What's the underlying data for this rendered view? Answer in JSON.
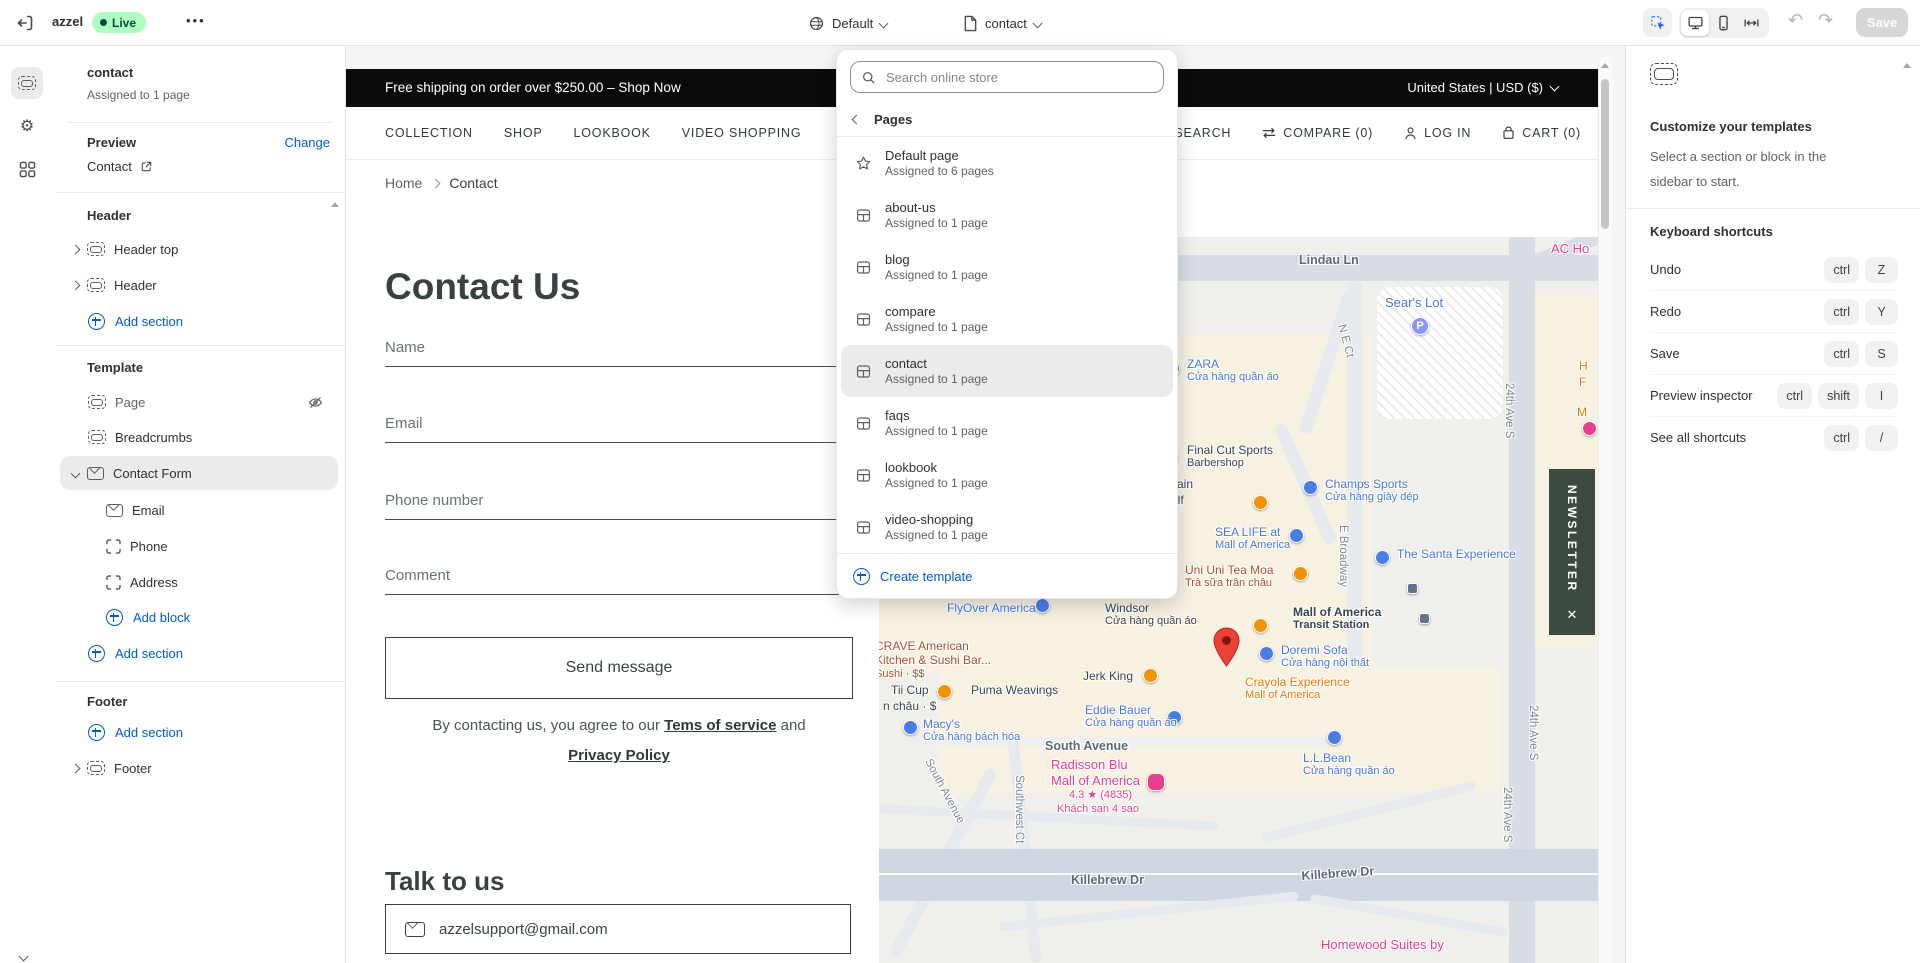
{
  "topbar": {
    "store_name": "azzel",
    "live_label": "Live",
    "more_label": "•••",
    "theme_name": "Default",
    "page_name": "contact",
    "save_label": "Save",
    "undo_glyph": "↶",
    "redo_glyph": "↷"
  },
  "sidebar": {
    "doc": {
      "title": "contact",
      "subtitle": "Assigned to 1 page"
    },
    "preview": {
      "label": "Preview",
      "change": "Change",
      "link": "Contact"
    },
    "header_group": {
      "title": "Header",
      "item1": "Header top",
      "item2": "Header",
      "add": "Add section"
    },
    "template_group": {
      "title": "Template",
      "page": "Page",
      "breadcrumbs": "Breadcrumbs",
      "contact_form": "Contact Form",
      "block1": "Email",
      "block2": "Phone",
      "block3": "Address",
      "add_block": "Add block",
      "add_section": "Add section"
    },
    "footer_group": {
      "title": "Footer",
      "add": "Add section",
      "footer": "Footer"
    }
  },
  "dropdown": {
    "search_placeholder": "Search online store",
    "back_label": "Pages",
    "items": [
      {
        "icon": "star",
        "title": "Default page",
        "subtitle": "Assigned to 6 pages"
      },
      {
        "icon": "template",
        "title": "about-us",
        "subtitle": "Assigned to 1 page"
      },
      {
        "icon": "template",
        "title": "blog",
        "subtitle": "Assigned to 1 page"
      },
      {
        "icon": "template",
        "title": "compare",
        "subtitle": "Assigned to 1 page"
      },
      {
        "icon": "template",
        "title": "contact",
        "subtitle": "Assigned to 1 page",
        "selected": true
      },
      {
        "icon": "template",
        "title": "faqs",
        "subtitle": "Assigned to 1 page"
      },
      {
        "icon": "template",
        "title": "lookbook",
        "subtitle": "Assigned to 1 page"
      },
      {
        "icon": "template",
        "title": "video-shopping",
        "subtitle": "Assigned to 1 page"
      }
    ],
    "create_label": "Create template"
  },
  "site": {
    "announcement": "Free shipping on order over $250.00 – Shop Now",
    "locale": "United States | USD ($)",
    "nav_links": [
      "COLLECTION",
      "SHOP",
      "LOOKBOOK",
      "VIDEO SHOPPING"
    ],
    "nav_utils": [
      "SEARCH",
      "COMPARE (0)",
      "LOG IN",
      "CART (0)"
    ],
    "breadcrumb_home": "Home",
    "breadcrumb_current": "Contact",
    "page_title": "Contact Us",
    "form": {
      "name_ph": "Name",
      "email_ph": "Email",
      "phone_ph": "Phone number",
      "comment_ph": "Comment",
      "submit": "Send message",
      "consent_prefix": "By contacting us, you agree to our ",
      "terms": "Tems of service",
      "consent_and": " and",
      "privacy": "Privacy Policy"
    },
    "talk_title": "Talk to us",
    "support_email": "azzelsupport@gmail.com",
    "newsletter": "NEWSLETTER",
    "newsletter_close": "✕"
  },
  "map": {
    "labels": [
      {
        "x": 420,
        "y": 16,
        "cls": "c-road b",
        "text": "Lindau Ln"
      },
      {
        "x": 672,
        "y": 4,
        "cls": "c-pink lg",
        "text": "AC Ho"
      },
      {
        "x": 506,
        "y": 58,
        "cls": "c-blue lg",
        "text": "Sear's Lot"
      },
      {
        "x": 532,
        "y": 80,
        "icon": "parking"
      },
      {
        "x": 468,
        "y": 86,
        "cls": "c-road",
        "rot": 75,
        "text": "N E Ct"
      },
      {
        "x": 286,
        "y": 124,
        "icon": "blue"
      },
      {
        "x": 308,
        "y": 120,
        "cls": "c-blue",
        "text": "ZARA",
        "sub": "Cửa hàng quần áo"
      },
      {
        "x": 700,
        "y": 122,
        "cls": "c-orange",
        "text": "H"
      },
      {
        "x": 700,
        "y": 138,
        "cls": "c-orange",
        "text": "F"
      },
      {
        "x": 698,
        "y": 168,
        "cls": "c-orange",
        "text": "M"
      },
      {
        "x": 703,
        "y": 184,
        "icon": "pink"
      },
      {
        "x": 636,
        "y": 146,
        "cls": "c-road",
        "rot": 90,
        "text": "24th Ave S"
      },
      {
        "x": 284,
        "y": 213,
        "icon": "black"
      },
      {
        "x": 308,
        "y": 206,
        "cls": "c-dark",
        "text": "Final Cut Sports",
        "sub": "Barbershop"
      },
      {
        "x": 288,
        "y": 240,
        "cls": "c-dark",
        "text": "ntain"
      },
      {
        "x": 292,
        "y": 256,
        "cls": "c-dark",
        "text": "olf"
      },
      {
        "x": 424,
        "y": 243,
        "icon": "blue"
      },
      {
        "x": 446,
        "y": 240,
        "cls": "c-blue",
        "text": "Champs Sports",
        "sub": "Cửa hàng giày dép"
      },
      {
        "x": 374,
        "y": 258,
        "icon": "orange"
      },
      {
        "x": 336,
        "y": 288,
        "cls": "c-blue",
        "text": "SEA LIFE at",
        "sub": "Mall of America"
      },
      {
        "x": 410,
        "y": 291,
        "icon": "blue"
      },
      {
        "x": 470,
        "y": 288,
        "cls": "c-road",
        "rot": 90,
        "text": "E Broadway"
      },
      {
        "x": 496,
        "y": 313,
        "icon": "blue"
      },
      {
        "x": 518,
        "y": 310,
        "cls": "c-blue",
        "text": "The Santa Experience"
      },
      {
        "x": 306,
        "y": 326,
        "cls": "c-maroon",
        "text": "Uni Uni Tea Moa",
        "sub": "Trà sữa trân châu"
      },
      {
        "x": 414,
        "y": 329,
        "icon": "orange"
      },
      {
        "x": 528,
        "y": 346,
        "icon": "transit"
      },
      {
        "x": 540,
        "y": 376,
        "icon": "transit"
      },
      {
        "x": 226,
        "y": 364,
        "cls": "c-dark",
        "text": "Windsor",
        "sub": "Cửa hàng quần áo"
      },
      {
        "x": 414,
        "y": 368,
        "cls": "c-dark b2",
        "text": "Mall of America",
        "sub": "Transit Station"
      },
      {
        "x": 68,
        "y": 364,
        "cls": "c-blue",
        "text": "FlyOver America"
      },
      {
        "x": 156,
        "y": 361,
        "icon": "blue"
      },
      {
        "x": 660,
        "y": 468,
        "cls": "c-road",
        "rot": 90,
        "text": "24th Ave S"
      },
      {
        "x": 634,
        "y": 550,
        "cls": "c-road",
        "rot": 90,
        "text": "24th Ave S"
      },
      {
        "x": -4,
        "y": 402,
        "cls": "c-maroon",
        "text": "CRAVE American\nKitchen & Sushi Bar...",
        "sub": "Sushi · $$"
      },
      {
        "x": 334,
        "y": 390,
        "icon": "pin"
      },
      {
        "x": 380,
        "y": 409,
        "icon": "blue"
      },
      {
        "x": 402,
        "y": 406,
        "cls": "c-blue",
        "text": "Doremi Sofa",
        "sub": "Cửa hàng nội thất"
      },
      {
        "x": 204,
        "y": 432,
        "cls": "c-dark",
        "text": "Jerk King"
      },
      {
        "x": 264,
        "y": 431,
        "icon": "orange"
      },
      {
        "x": 374,
        "y": 381,
        "icon": "orange"
      },
      {
        "x": 366,
        "y": 438,
        "cls": "c-crayola",
        "text": "Crayola Experience",
        "sub": "Mall of America"
      },
      {
        "x": 12,
        "y": 446,
        "cls": "c-dark",
        "text": "Tii Cup"
      },
      {
        "x": 4,
        "y": 462,
        "cls": "c-dark",
        "text": "n châu · $"
      },
      {
        "x": 58,
        "y": 447,
        "icon": "orange"
      },
      {
        "x": 92,
        "y": 446,
        "cls": "c-dark",
        "text": "Puma Weavings"
      },
      {
        "x": 288,
        "y": 473,
        "icon": "blue"
      },
      {
        "x": 206,
        "y": 466,
        "cls": "c-blue",
        "text": "Eddie Bauer",
        "sub": "Cửa hàng quần áo"
      },
      {
        "x": 24,
        "y": 483,
        "icon": "blue"
      },
      {
        "x": 44,
        "y": 480,
        "cls": "c-blue",
        "text": "Macy's",
        "sub": "Cửa hàng bách hóa"
      },
      {
        "x": 166,
        "y": 502,
        "cls": "c-road b",
        "text": "South Avenue"
      },
      {
        "x": 172,
        "y": 520,
        "cls": "c-pink lg",
        "text": "Radisson Blu\nMall of America"
      },
      {
        "x": 268,
        "y": 536,
        "icon": "hotel"
      },
      {
        "x": 190,
        "y": 552,
        "cls": "c-pink sm",
        "text": "4.3 ★ (4835)"
      },
      {
        "x": 178,
        "y": 566,
        "cls": "c-pink sm",
        "text": "Khách sạn 4 sao"
      },
      {
        "x": 448,
        "y": 493,
        "icon": "blue"
      },
      {
        "x": 424,
        "y": 514,
        "cls": "c-blue",
        "text": "L.L.Bean",
        "sub": "Cửa hàng quần áo"
      },
      {
        "x": 146,
        "y": 538,
        "cls": "c-road",
        "rot": 90,
        "text": "Southwest Ct"
      },
      {
        "x": 54,
        "y": 520,
        "cls": "c-road",
        "rot": 62,
        "text": "South Avenue"
      },
      {
        "x": 192,
        "y": 636,
        "cls": "c-road b",
        "text": "Killebrew Dr"
      },
      {
        "x": 422,
        "y": 632,
        "cls": "c-road b",
        "rot": -4,
        "text": "Killebrew Dr"
      },
      {
        "x": 442,
        "y": 700,
        "cls": "c-pink lg",
        "text": "Homewood Suites by"
      }
    ]
  },
  "right_panel": {
    "title": "Customize your templates",
    "subtitle": "Select a section or block in the sidebar to start.",
    "shortcuts_title": "Keyboard shortcuts",
    "shortcuts": [
      {
        "label": "Undo",
        "keys": [
          "ctrl",
          "Z"
        ]
      },
      {
        "label": "Redo",
        "keys": [
          "ctrl",
          "Y"
        ]
      },
      {
        "label": "Save",
        "keys": [
          "ctrl",
          "S"
        ]
      },
      {
        "label": "Preview inspector",
        "keys": [
          "ctrl",
          "shift",
          "I"
        ]
      },
      {
        "label": "See all shortcuts",
        "keys": [
          "ctrl",
          "/"
        ]
      }
    ]
  },
  "colors": {
    "accent_blue": "#005bd3",
    "live_badge_bg": "#affebf",
    "live_badge_text": "#014b40",
    "site_dark": "#39433c",
    "newsletter_bg": "#3d4a42",
    "map_pin_red": "#ea4335",
    "announcement_bg": "#0b0b0b"
  }
}
